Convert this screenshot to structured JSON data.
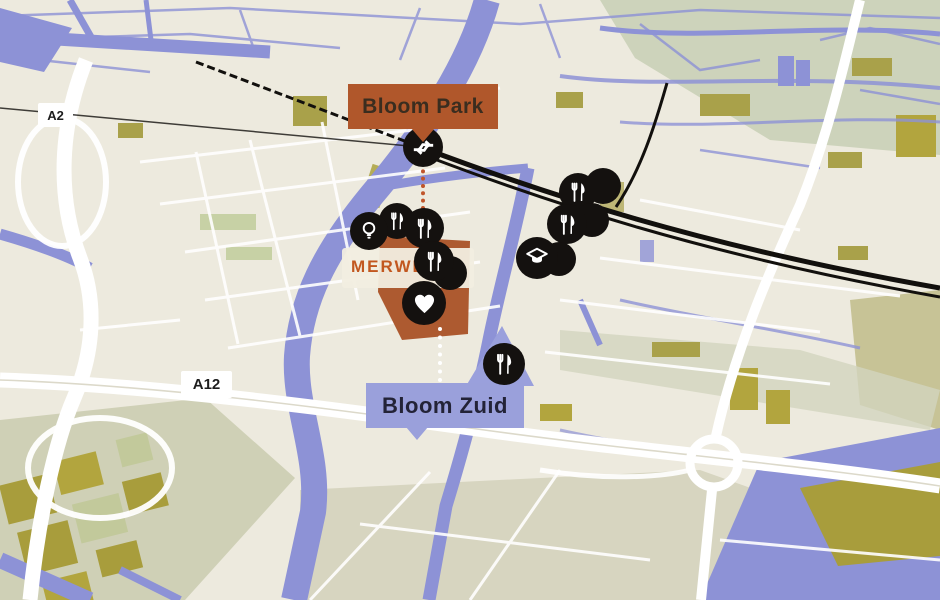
{
  "map": {
    "labels": {
      "bloom_park": "Bloom Park",
      "bloom_zuid": "Bloom Zuid",
      "merwede": "MERWEDE",
      "a2": "A2",
      "a12": "A12"
    },
    "colors": {
      "bloom_park": "#b0572b",
      "bloom_zuid": "#9aa0db",
      "water": "#8d92d6",
      "marker": "#14110f",
      "merwede_text": "#c2571f",
      "map_bg": "#edeade"
    },
    "markers": [
      {
        "icon": "transit",
        "x": 423,
        "y": 147,
        "d": 40
      },
      {
        "icon": "restaurant",
        "x": 397,
        "y": 221,
        "d": 36
      },
      {
        "icon": "lightbulb",
        "x": 369,
        "y": 231,
        "d": 38
      },
      {
        "icon": "restaurant",
        "x": 424,
        "y": 228,
        "d": 40
      },
      {
        "icon": "poi",
        "x": 450,
        "y": 273,
        "d": 34
      },
      {
        "icon": "restaurant",
        "x": 434,
        "y": 261,
        "d": 40
      },
      {
        "icon": "heart",
        "x": 424,
        "y": 303,
        "d": 44
      },
      {
        "icon": "restaurant",
        "x": 578,
        "y": 192,
        "d": 38
      },
      {
        "icon": "poi",
        "x": 603,
        "y": 186,
        "d": 36
      },
      {
        "icon": "poi",
        "x": 592,
        "y": 220,
        "d": 34
      },
      {
        "icon": "restaurant",
        "x": 567,
        "y": 224,
        "d": 40
      },
      {
        "icon": "poi",
        "x": 559,
        "y": 259,
        "d": 34
      },
      {
        "icon": "graduation-cap",
        "x": 537,
        "y": 258,
        "d": 42
      },
      {
        "icon": "restaurant",
        "x": 504,
        "y": 364,
        "d": 42
      }
    ],
    "connectors": [
      {
        "id": "bloom-park-link",
        "color": "#c0552a",
        "x": 421,
        "y1": 162,
        "y2": 210
      },
      {
        "id": "bloom-zuid-link",
        "color": "#ffffff",
        "x": 438,
        "y1": 327,
        "y2": 382
      }
    ]
  }
}
